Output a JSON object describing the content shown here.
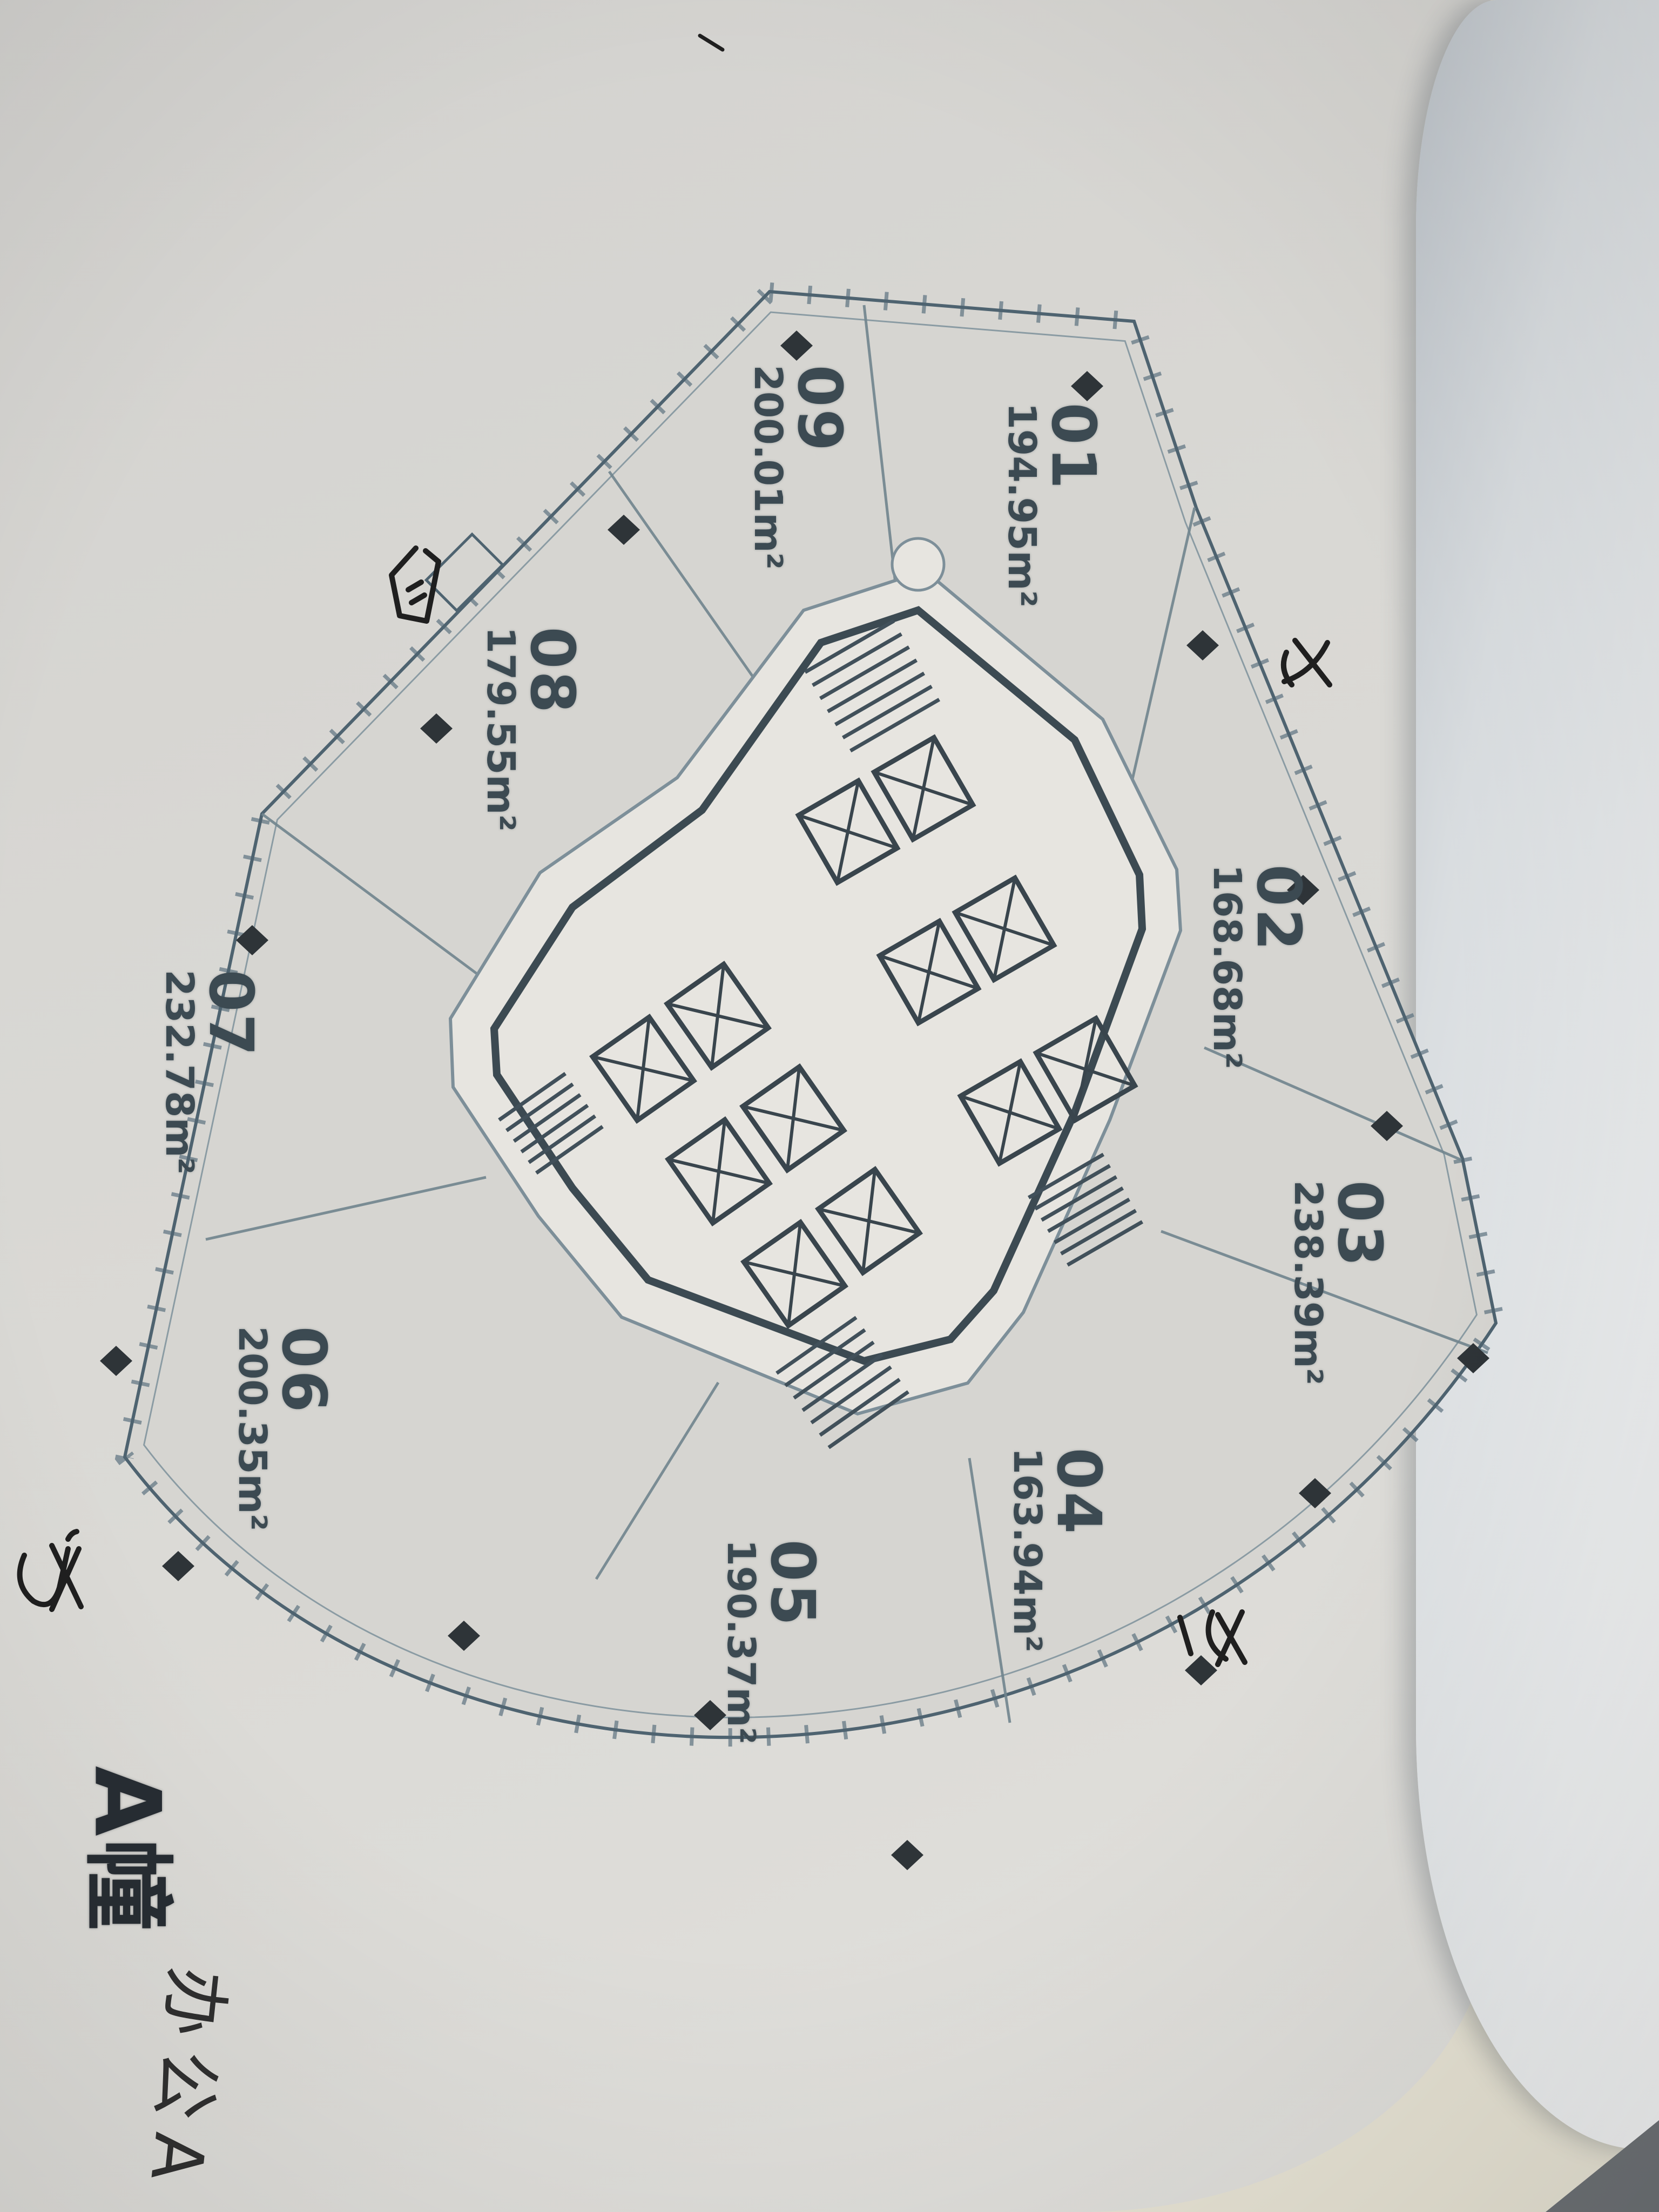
{
  "plan": {
    "building_label": "A幢",
    "handwritten_note": "办公A",
    "units": [
      {
        "id": "01",
        "area": "194.95m²"
      },
      {
        "id": "02",
        "area": "168.68m²"
      },
      {
        "id": "03",
        "area": "238.39m²"
      },
      {
        "id": "04",
        "area": "163.94m²"
      },
      {
        "id": "05",
        "area": "190.37m²"
      },
      {
        "id": "06",
        "area": "200.35m²"
      },
      {
        "id": "07",
        "area": "232.78m²"
      },
      {
        "id": "08",
        "area": "179.55m²"
      },
      {
        "id": "09",
        "area": "200.01m²"
      }
    ],
    "colors": {
      "plan_line": "#4e6370",
      "divider_line": "#71858e",
      "printed_text": "#3c4a52",
      "column_marker": "#2e3438",
      "handwriting_ink": "#1f1f1f",
      "paper": "#d9d8d4",
      "page_curl": "#f3f4f4"
    },
    "icons": {
      "column_marker": "filled-diamond",
      "elevator_shaft": "crossed-box",
      "stair": "hatch-lines"
    },
    "annotations": [
      "handwritten-scribble-upper-left",
      "handwritten-scribble-top-right",
      "handwritten-scribble-right",
      "handwritten-scribble-bottom-left"
    ]
  }
}
